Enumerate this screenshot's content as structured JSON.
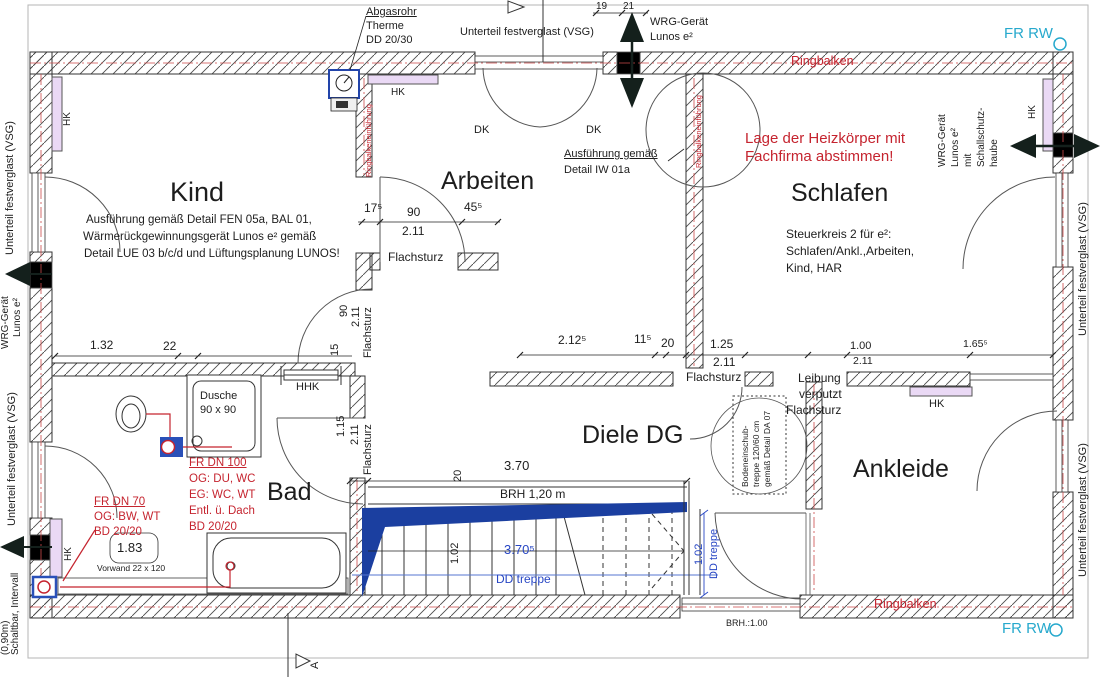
{
  "colors": {
    "annotation_red": "#c5242f",
    "stair_blue": "#2746c4",
    "fr_rw_cyan": "#27a9cd",
    "stair_wedge_fill": "#1b3fa0",
    "radiator_fill": "#ead9f5",
    "duct_gray": "#bdbdbd"
  },
  "rooms": [
    "Kind",
    "Arbeiten",
    "Schlafen",
    "Bad",
    "Diele DG",
    "Ankleide"
  ],
  "annotations": [
    {
      "n": "label-abgasrohr-1",
      "t": "Abgasrohr",
      "x": 366,
      "y": 6,
      "fs": 11,
      "u": 1
    },
    {
      "n": "label-abgasrohr-2",
      "t": "Therme",
      "x": 366,
      "y": 20,
      "fs": 11
    },
    {
      "n": "label-abgasrohr-3",
      "t": "DD 20/30",
      "x": 366,
      "y": 34,
      "fs": 11
    },
    {
      "n": "label-top-window",
      "t": "Unterteil festverglast (VSG)",
      "x": 460,
      "y": 26,
      "fs": 11
    },
    {
      "n": "dim-19",
      "t": "19",
      "x": 596,
      "y": 1,
      "fs": 10
    },
    {
      "n": "dim-21",
      "t": "21",
      "x": 623,
      "y": 1,
      "fs": 10
    },
    {
      "n": "label-wrg-top-1",
      "t": "WRG-Gerät",
      "x": 650,
      "y": 16,
      "fs": 11
    },
    {
      "n": "label-wrg-top-2",
      "t": "Lunos e²",
      "x": 650,
      "y": 31,
      "fs": 11
    },
    {
      "n": "label-fr-rw-top",
      "t": "FR RW",
      "x": 1004,
      "y": 26,
      "fs": 15,
      "c": "cyan"
    },
    {
      "n": "label-ringbalken-top",
      "t": "Ringbalken",
      "x": 791,
      "y": 55,
      "fs": 12.5,
      "c": "red"
    },
    {
      "n": "label-hk-arbeiten",
      "t": "HK",
      "x": 391,
      "y": 87,
      "fs": 10
    },
    {
      "n": "label-dk-left",
      "t": "DK",
      "x": 474,
      "y": 124,
      "fs": 11
    },
    {
      "n": "label-dk-right",
      "t": "DK",
      "x": 586,
      "y": 124,
      "fs": 11
    },
    {
      "n": "label-iw01a-1",
      "t": "Ausführung gemäß",
      "x": 564,
      "y": 148,
      "fs": 11,
      "u": 1
    },
    {
      "n": "label-iw01a-2",
      "t": "Detail IW 01a",
      "x": 564,
      "y": 164,
      "fs": 11
    },
    {
      "n": "note-heizkoerper-1",
      "t": "Lage der Heizkörper mit",
      "x": 745,
      "y": 131,
      "fs": 15,
      "c": "red"
    },
    {
      "n": "note-heizkoerper-2",
      "t": "Fachfirma abstimmen!",
      "x": 745,
      "y": 149,
      "fs": 15,
      "c": "red"
    },
    {
      "n": "room-kind",
      "t": "Kind",
      "x": 170,
      "y": 178,
      "fs": 27
    },
    {
      "n": "note-kind-1",
      "t": "Ausführung gemäß Detail FEN 05a, BAL 01,",
      "x": 86,
      "y": 214,
      "fs": 11.5
    },
    {
      "n": "note-kind-2",
      "t": "Wärmerückgewinnungsgerät Lunos e² gemäß",
      "x": 83,
      "y": 231,
      "fs": 11.5
    },
    {
      "n": "note-kind-3",
      "t": "Detail LUE 03 b/c/d und Lüftungsplanung LUNOS!",
      "x": 84,
      "y": 248,
      "fs": 11.5
    },
    {
      "n": "room-arbeiten",
      "t": "Arbeiten",
      "x": 441,
      "y": 168,
      "fs": 25
    },
    {
      "n": "room-schlafen",
      "t": "Schlafen",
      "x": 791,
      "y": 180,
      "fs": 25
    },
    {
      "n": "note-steuerkreis-1",
      "t": "Steuerkreis 2 für e²:",
      "x": 786,
      "y": 228,
      "fs": 12
    },
    {
      "n": "note-steuerkreis-2",
      "t": "Schlafen/Ankl.,Arbeiten,",
      "x": 786,
      "y": 245,
      "fs": 12
    },
    {
      "n": "note-steuerkreis-3",
      "t": "Kind, HAR",
      "x": 786,
      "y": 262,
      "fs": 12
    },
    {
      "n": "dim-175",
      "t": "17⁵",
      "x": 364,
      "y": 202,
      "fs": 12
    },
    {
      "n": "dim-90",
      "t": "90",
      "x": 407,
      "y": 206,
      "fs": 12
    },
    {
      "n": "dim-455",
      "t": "45⁵",
      "x": 464,
      "y": 201,
      "fs": 12
    },
    {
      "n": "dim-211-a",
      "t": "2.11",
      "x": 402,
      "y": 225,
      "fs": 12
    },
    {
      "n": "label-flachsturz-a",
      "t": "Flachsturz",
      "x": 388,
      "y": 251,
      "fs": 12
    },
    {
      "n": "dim-132",
      "t": "1.32",
      "x": 90,
      "y": 339,
      "fs": 12
    },
    {
      "n": "dim-22",
      "t": "22",
      "x": 163,
      "y": 340,
      "fs": 12
    },
    {
      "n": "label-hhk",
      "t": "HHK",
      "x": 296,
      "y": 381,
      "fs": 11
    },
    {
      "n": "dim-2125",
      "t": "2.12⁵",
      "x": 558,
      "y": 334,
      "fs": 12
    },
    {
      "n": "dim-115",
      "t": "11⁵",
      "x": 634,
      "y": 333,
      "fs": 12
    },
    {
      "n": "dim-20",
      "t": "20",
      "x": 661,
      "y": 337,
      "fs": 12
    },
    {
      "n": "dim-125",
      "t": "1.25",
      "x": 710,
      "y": 338,
      "fs": 12
    },
    {
      "n": "dim-100",
      "t": "1.00",
      "x": 850,
      "y": 340,
      "fs": 11
    },
    {
      "n": "dim-1655",
      "t": "1.65⁵",
      "x": 963,
      "y": 339,
      "fs": 10.5
    },
    {
      "n": "dim-211-b",
      "t": "2.11",
      "x": 713,
      "y": 356,
      "fs": 12
    },
    {
      "n": "label-flachsturz-b",
      "t": "Flachsturz",
      "x": 686,
      "y": 371,
      "fs": 12
    },
    {
      "n": "dim-211-c",
      "t": "2.11",
      "x": 853,
      "y": 356,
      "fs": 10.5
    },
    {
      "n": "label-leibung-1",
      "t": "Leibung",
      "x": 798,
      "y": 372,
      "fs": 12
    },
    {
      "n": "label-leibung-2",
      "t": "verputzt",
      "x": 799,
      "y": 388,
      "fs": 12
    },
    {
      "n": "label-leibung-3",
      "t": "Flachsturz",
      "x": 786,
      "y": 404,
      "fs": 12
    },
    {
      "n": "label-hk-ankleide",
      "t": "HK",
      "x": 929,
      "y": 398,
      "fs": 11
    },
    {
      "n": "room-bad",
      "t": "Bad",
      "x": 267,
      "y": 479,
      "fs": 25
    },
    {
      "n": "label-dusche-1",
      "t": "Dusche",
      "x": 200,
      "y": 390,
      "fs": 11
    },
    {
      "n": "label-dusche-2",
      "t": "90 x 90",
      "x": 200,
      "y": 404,
      "fs": 11
    },
    {
      "n": "note-fr100-1",
      "t": "FR DN 100",
      "x": 189,
      "y": 457,
      "fs": 11.5,
      "c": "red",
      "u": 1
    },
    {
      "n": "note-fr100-2",
      "t": "OG: DU, WC",
      "x": 189,
      "y": 473,
      "fs": 11.5,
      "c": "red"
    },
    {
      "n": "note-fr100-3",
      "t": "EG: WC, WT",
      "x": 189,
      "y": 489,
      "fs": 11.5,
      "c": "red"
    },
    {
      "n": "note-fr100-4",
      "t": "Entl. ü. Dach",
      "x": 189,
      "y": 505,
      "fs": 11.5,
      "c": "red"
    },
    {
      "n": "note-fr100-5",
      "t": "BD 20/20",
      "x": 189,
      "y": 521,
      "fs": 11.5,
      "c": "red"
    },
    {
      "n": "note-fr70-1",
      "t": "FR DN 70",
      "x": 94,
      "y": 496,
      "fs": 11.5,
      "c": "red",
      "u": 1
    },
    {
      "n": "note-fr70-2",
      "t": "OG: BW, WT",
      "x": 94,
      "y": 511,
      "fs": 11.5,
      "c": "red"
    },
    {
      "n": "note-fr70-3",
      "t": "BD 20/20",
      "x": 94,
      "y": 526,
      "fs": 11.5,
      "c": "red"
    },
    {
      "n": "dim-183",
      "t": "1.83",
      "x": 117,
      "y": 541,
      "fs": 13
    },
    {
      "n": "label-vorwand",
      "t": "Vorwand 22 x 120",
      "x": 97,
      "y": 564,
      "fs": 8.5
    },
    {
      "n": "room-diele",
      "t": "Diele DG",
      "x": 582,
      "y": 422,
      "fs": 25
    },
    {
      "n": "dim-370",
      "t": "3.70",
      "x": 504,
      "y": 459,
      "fs": 13
    },
    {
      "n": "label-brh120",
      "t": "BRH 1,20 m",
      "x": 500,
      "y": 488,
      "fs": 12
    },
    {
      "n": "dim-3705",
      "t": "3.70⁵",
      "x": 504,
      "y": 543,
      "fs": 13,
      "c": "blue"
    },
    {
      "n": "label-dd-treppe",
      "t": "DD treppe",
      "x": 496,
      "y": 573,
      "fs": 12,
      "c": "blue"
    },
    {
      "n": "room-ankleide",
      "t": "Ankleide",
      "x": 853,
      "y": 456,
      "fs": 25
    },
    {
      "n": "label-ringbalken-bottom",
      "t": "Ringbalken",
      "x": 874,
      "y": 598,
      "fs": 12.5,
      "c": "red"
    },
    {
      "n": "label-brh100",
      "t": "BRH.:1.00",
      "x": 726,
      "y": 619,
      "fs": 9
    },
    {
      "n": "label-fr-rw-bottom",
      "t": "FR RW",
      "x": 1002,
      "y": 621,
      "fs": 15,
      "c": "cyan"
    },
    {
      "n": "label-hk-kind",
      "t": "HK",
      "x": 62,
      "y": 126,
      "fs": 10,
      "r": 1
    },
    {
      "n": "label-ringbalkeneinf-1",
      "t": "Ringbalkeneinführung",
      "x": 365,
      "y": 177,
      "fs": 7.5,
      "c": "red",
      "r": 1
    },
    {
      "n": "label-ringbalkeneinf-2",
      "t": "Ringbalkeneinführung",
      "x": 695,
      "y": 168,
      "fs": 7.5,
      "c": "red",
      "r": 1
    },
    {
      "n": "label-wrg-left-1",
      "t": "WRG-Gerät",
      "x": 0,
      "y": 349,
      "fs": 10,
      "r": 1
    },
    {
      "n": "label-wrg-left-2",
      "t": "Lunos e²",
      "x": 12,
      "y": 337,
      "fs": 10,
      "r": 1
    },
    {
      "n": "label-vsg-left-1",
      "t": "Unterteil festverglast (VSG)",
      "x": 4,
      "y": 255,
      "fs": 11,
      "r": 1
    },
    {
      "n": "label-vsg-left-2",
      "t": "Unterteil festverglast (VSG)",
      "x": 6,
      "y": 526,
      "fs": 11,
      "r": 1
    },
    {
      "n": "label-schaltbar",
      "t": "Schaltbar, Intervall",
      "x": 10,
      "y": 655,
      "fs": 10,
      "r": 1
    },
    {
      "n": "label-edge-cut",
      "t": "(0,90m)",
      "x": 0,
      "y": 655,
      "fs": 10,
      "r": 1
    },
    {
      "n": "label-wrg-right-1",
      "t": "WRG-Gerät",
      "x": 937,
      "y": 167,
      "fs": 10,
      "r": 1
    },
    {
      "n": "label-wrg-right-2",
      "t": "Lunos e²",
      "x": 950,
      "y": 167,
      "fs": 10,
      "r": 1
    },
    {
      "n": "label-wrg-right-3",
      "t": "mit",
      "x": 963,
      "y": 167,
      "fs": 10,
      "r": 1
    },
    {
      "n": "label-wrg-right-4",
      "t": "Schallschutz-",
      "x": 976,
      "y": 167,
      "fs": 10,
      "r": 1
    },
    {
      "n": "label-wrg-right-5",
      "t": "haube",
      "x": 989,
      "y": 167,
      "fs": 10,
      "r": 1
    },
    {
      "n": "label-hk-schlafen",
      "t": "HK",
      "x": 1027,
      "y": 119,
      "fs": 10,
      "r": 1
    },
    {
      "n": "label-vsg-right-1",
      "t": "Unterteil festverglast (VSG)",
      "x": 1077,
      "y": 336,
      "fs": 11,
      "r": 1
    },
    {
      "n": "label-vsg-right-2",
      "t": "Unterteil festverglast (VSG)",
      "x": 1077,
      "y": 577,
      "fs": 11,
      "r": 1
    },
    {
      "n": "dim-90-rot",
      "t": "90",
      "x": 338,
      "y": 317,
      "fs": 11,
      "r": 1
    },
    {
      "n": "dim-211-rot-a",
      "t": "2.11",
      "x": 350,
      "y": 327,
      "fs": 11,
      "r": 1
    },
    {
      "n": "label-flachsturz-rot-a",
      "t": "Flachsturz",
      "x": 362,
      "y": 358,
      "fs": 11,
      "r": 1
    },
    {
      "n": "dim-15-rot",
      "t": "15",
      "x": 329,
      "y": 356,
      "fs": 11,
      "r": 1
    },
    {
      "n": "dim-115-rot",
      "t": "1.15",
      "x": 335,
      "y": 437,
      "fs": 11,
      "r": 1
    },
    {
      "n": "dim-211-rot-b",
      "t": "2.11",
      "x": 349,
      "y": 445,
      "fs": 11,
      "r": 1
    },
    {
      "n": "label-flachsturz-rot-b",
      "t": "Flachsturz",
      "x": 362,
      "y": 475,
      "fs": 11,
      "r": 1
    },
    {
      "n": "dim-20-rot",
      "t": "20",
      "x": 452,
      "y": 482,
      "fs": 11,
      "r": 1
    },
    {
      "n": "dim-102-left",
      "t": "1.02",
      "x": 449,
      "y": 564,
      "fs": 11,
      "r": 1
    },
    {
      "n": "dim-102-right",
      "t": "1.02",
      "x": 693,
      "y": 565,
      "fs": 11,
      "c": "blue",
      "r": 1
    },
    {
      "n": "label-dd-treppe-rot",
      "t": "DD treppe",
      "x": 708,
      "y": 579,
      "fs": 11,
      "c": "blue",
      "r": 1
    },
    {
      "n": "label-section-a",
      "t": "A",
      "x": 309,
      "y": 669,
      "fs": 11,
      "r": 1
    },
    {
      "n": "note-bodeneinschub-1",
      "t": "Bodeneinschub-",
      "x": 741,
      "y": 487,
      "fs": 8.5,
      "r": 1
    },
    {
      "n": "note-bodeneinschub-2",
      "t": "treppe 120/60 cm",
      "x": 752,
      "y": 487,
      "fs": 8.5,
      "r": 1
    },
    {
      "n": "note-bodeneinschub-3",
      "t": "gemäß Detail DA 07",
      "x": 763,
      "y": 487,
      "fs": 8.5,
      "r": 1
    },
    {
      "n": "label-hk-bad",
      "t": "HK",
      "x": 63,
      "y": 561,
      "fs": 10,
      "r": 1
    }
  ]
}
